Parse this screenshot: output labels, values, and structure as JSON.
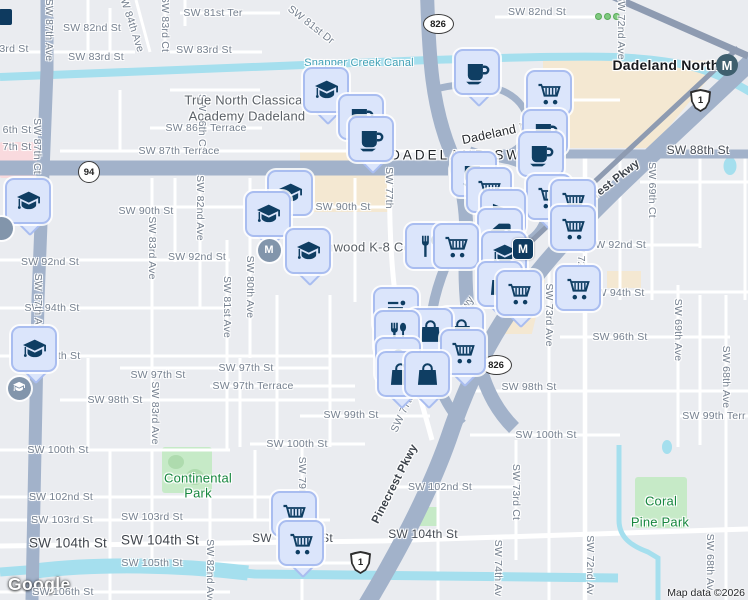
{
  "attribution": {
    "logo": "Google",
    "map_data": "Map data ©2026"
  },
  "colors": {
    "land": "#eaecf0",
    "road_major": "#a2b2ca",
    "road_minor": "#ffffff",
    "water": "#a5dfee",
    "park": "#c6eac7",
    "commercial": "#f4e8d2",
    "pin_fill": "#dbe5fb",
    "pin_border": "#a9bdf0",
    "pin_icon": "#0f3e63",
    "park_text": "#17873f",
    "water_text": "#41a0b5"
  },
  "labels": [
    {
      "t": "SW 82nd St",
      "x": 92,
      "y": 28
    },
    {
      "t": "3rd St",
      "x": 14,
      "y": 49
    },
    {
      "t": "SW 83rd St",
      "x": 96,
      "y": 57
    },
    {
      "t": "SW 84th Ave",
      "x": 131,
      "y": 22,
      "r": 72
    },
    {
      "t": "SW 83rd Ct",
      "x": 165,
      "y": 24,
      "r": 90
    },
    {
      "t": "SW 81st Ter",
      "x": 213,
      "y": 13
    },
    {
      "t": "SW 81st Dr",
      "x": 311,
      "y": 25,
      "r": 38
    },
    {
      "t": "SW 83rd St",
      "x": 204,
      "y": 50
    },
    {
      "t": "SW 82nd St",
      "x": 537,
      "y": 12
    },
    {
      "t": "SW 72nd Ave",
      "x": 621,
      "y": 27,
      "r": 90
    },
    {
      "t": "SW 86th Terrace",
      "x": 206,
      "y": 128
    },
    {
      "t": "6th St",
      "x": 17,
      "y": 130
    },
    {
      "t": "7th St",
      "x": 17,
      "y": 147
    },
    {
      "t": "SW 87th Ct",
      "x": 37,
      "y": 146,
      "r": 90
    },
    {
      "t": "SW 86th Ct",
      "x": 202,
      "y": 122,
      "r": 90
    },
    {
      "t": "SW 87th Terrace",
      "x": 179,
      "y": 151
    },
    {
      "t": "SW 90th St",
      "x": 146,
      "y": 211
    },
    {
      "t": "SW 90th St",
      "x": 343,
      "y": 207
    },
    {
      "t": "SW 82nd Ave",
      "x": 200,
      "y": 208,
      "r": 90
    },
    {
      "t": "SW 83rd Ave",
      "x": 152,
      "y": 248,
      "r": 90
    },
    {
      "t": "SW 92nd St",
      "x": 50,
      "y": 262
    },
    {
      "t": "SW 92nd St",
      "x": 197,
      "y": 257
    },
    {
      "t": "SW 80th Ave",
      "x": 250,
      "y": 287,
      "r": 90
    },
    {
      "t": "SW 81st Ave",
      "x": 227,
      "y": 307,
      "r": 90
    },
    {
      "t": "SW 92nd St",
      "x": 617,
      "y": 245
    },
    {
      "t": "SW 69th Ct",
      "x": 652,
      "y": 190,
      "r": 90
    },
    {
      "t": "SW 94th St",
      "x": 52,
      "y": 308
    },
    {
      "t": "SW 94th St",
      "x": 617,
      "y": 293
    },
    {
      "t": "SW 73rd Ave",
      "x": 549,
      "y": 315,
      "r": 90
    },
    {
      "t": "SW 72nd Ave",
      "x": 581,
      "y": 268,
      "r": 90
    },
    {
      "t": "SW 96th St",
      "x": 620,
      "y": 337
    },
    {
      "t": "SW 69th Ave",
      "x": 678,
      "y": 330,
      "r": 90
    },
    {
      "t": "SW 68th Ave",
      "x": 726,
      "y": 377,
      "r": 90
    },
    {
      "t": "6th St",
      "x": 66,
      "y": 356
    },
    {
      "t": "SW 97th St",
      "x": 158,
      "y": 375
    },
    {
      "t": "SW 97th St",
      "x": 246,
      "y": 368
    },
    {
      "t": "SW 97th Terrace",
      "x": 253,
      "y": 386
    },
    {
      "t": "SW 98th St",
      "x": 115,
      "y": 400
    },
    {
      "t": "SW 83rd Ave",
      "x": 155,
      "y": 413,
      "r": 90
    },
    {
      "t": "SW 99th St",
      "x": 351,
      "y": 415
    },
    {
      "t": "SW 98th St",
      "x": 529,
      "y": 387
    },
    {
      "t": "SW 99th Terr",
      "x": 714,
      "y": 416
    },
    {
      "t": "SW 100th St",
      "x": 546,
      "y": 435
    },
    {
      "t": "SW 100th St",
      "x": 58,
      "y": 450
    },
    {
      "t": "SW 100th St",
      "x": 297,
      "y": 444
    },
    {
      "t": "SW 102nd St",
      "x": 61,
      "y": 497
    },
    {
      "t": "SW 102nd St",
      "x": 440,
      "y": 487
    },
    {
      "t": "SW 103rd St",
      "x": 62,
      "y": 520
    },
    {
      "t": "SW 103rd St",
      "x": 152,
      "y": 517
    },
    {
      "t": "SW 105th St",
      "x": 152,
      "y": 563
    },
    {
      "t": "SW 106th St",
      "x": 63,
      "y": 592
    },
    {
      "t": "SW 82nd Ave",
      "x": 210,
      "y": 572,
      "r": 90
    },
    {
      "t": "SW 74th Av",
      "x": 498,
      "y": 568,
      "r": 90
    },
    {
      "t": "SW 73rd Ct",
      "x": 516,
      "y": 492,
      "r": 90
    },
    {
      "t": "SW 72nd Av",
      "x": 590,
      "y": 565,
      "r": 90
    },
    {
      "t": "SW 68th Av",
      "x": 710,
      "y": 562,
      "r": 90
    },
    {
      "t": "SW 79th Av",
      "x": 302,
      "y": 485,
      "r": 90
    },
    {
      "t": "SW 87th Ave",
      "x": 49,
      "y": 30,
      "r": 90
    },
    {
      "t": "SW 87th Ave",
      "x": 38,
      "y": 305,
      "r": 90
    },
    {
      "t": "SW 77th",
      "x": 389,
      "y": 188,
      "r": 90
    },
    {
      "t": "SW 77th Av",
      "x": 406,
      "y": 406,
      "r": -65
    },
    {
      "t": "e Hwy",
      "x": 463,
      "y": 310,
      "r": -55
    },
    {
      "t": "SW 88th St",
      "x": 698,
      "y": 150,
      "c": "M"
    },
    {
      "t": "SW 104th St",
      "x": 423,
      "y": 534,
      "c": "M"
    },
    {
      "t": "SW",
      "x": 262,
      "y": 538,
      "c": "M"
    },
    {
      "t": "St",
      "x": 327,
      "y": 538,
      "c": "M"
    },
    {
      "t": "SW 104th St",
      "x": 68,
      "y": 543,
      "c": "B"
    },
    {
      "t": "SW 104th St",
      "x": 160,
      "y": 540,
      "c": "B"
    },
    {
      "t": "DADELAND SW 88",
      "x": 470,
      "y": 155,
      "c": "A"
    },
    {
      "t": "Dadeland North",
      "x": 666,
      "y": 65,
      "c": "T"
    },
    {
      "t": "True North Classical",
      "x": 245,
      "y": 100,
      "c": "P"
    },
    {
      "t": "Academy Dadeland",
      "x": 247,
      "y": 116,
      "c": "P"
    },
    {
      "t": "Kenwood K-8 Center",
      "x": 372,
      "y": 247,
      "c": "P"
    },
    {
      "t": "Dadeland M",
      "x": 496,
      "y": 133,
      "r": -12,
      "c": "L"
    },
    {
      "t": "Snapper Creek Canal",
      "x": 359,
      "y": 63,
      "c": "W"
    },
    {
      "t": "Continental",
      "x": 198,
      "y": 478,
      "c": "K"
    },
    {
      "t": "Park",
      "x": 198,
      "y": 493,
      "c": "K"
    },
    {
      "t": "Coral",
      "x": 661,
      "y": 501,
      "c": "K"
    },
    {
      "t": "Pine Park",
      "x": 660,
      "y": 522,
      "c": "K"
    },
    {
      "t": "Pinecrest Pkwy",
      "x": 604,
      "y": 189,
      "r": -38,
      "c": "R"
    },
    {
      "t": "Pinecrest Pkwy",
      "x": 395,
      "y": 484,
      "r": -63,
      "c": "R"
    }
  ],
  "shields": [
    {
      "k": "oval",
      "t": "826",
      "x": 437,
      "y": 23
    },
    {
      "k": "oval",
      "t": "826",
      "x": 430,
      "y": 317
    },
    {
      "k": "oval",
      "t": "826",
      "x": 495,
      "y": 364
    },
    {
      "k": "circle",
      "t": "94",
      "x": 88,
      "y": 171
    },
    {
      "k": "us",
      "t": "1",
      "x": 700,
      "y": 100
    },
    {
      "k": "us",
      "t": "1",
      "x": 360,
      "y": 562
    }
  ],
  "markers": [
    {
      "icon": "coffee",
      "x": 477,
      "y": 72,
      "tail": true
    },
    {
      "icon": "graduation",
      "x": 326,
      "y": 90,
      "tail": true
    },
    {
      "icon": "cart",
      "x": 549,
      "y": 93,
      "tail": true
    },
    {
      "icon": "coffee",
      "x": 361,
      "y": 117
    },
    {
      "icon": "coffee",
      "x": 545,
      "y": 132
    },
    {
      "icon": "coffee",
      "x": 371,
      "y": 139,
      "tail": true
    },
    {
      "icon": "coffee",
      "x": 541,
      "y": 154,
      "tail": true
    },
    {
      "icon": "coffee",
      "x": 474,
      "y": 174
    },
    {
      "icon": "cart",
      "x": 489,
      "y": 190
    },
    {
      "icon": "graduation",
      "x": 290,
      "y": 193
    },
    {
      "icon": "cart",
      "x": 549,
      "y": 197,
      "tail": true
    },
    {
      "icon": "graduation",
      "x": 28,
      "y": 201,
      "tail": true
    },
    {
      "icon": "cart",
      "x": 573,
      "y": 202
    },
    {
      "icon": "arrow",
      "x": 503,
      "y": 212
    },
    {
      "icon": "graduation",
      "x": 268,
      "y": 214,
      "tail": true
    },
    {
      "icon": "cart",
      "x": 573,
      "y": 228
    },
    {
      "icon": "tag",
      "x": 500,
      "y": 231
    },
    {
      "icon": "restaurant",
      "x": 428,
      "y": 246
    },
    {
      "icon": "cart",
      "x": 456,
      "y": 246
    },
    {
      "icon": "graduation",
      "x": 308,
      "y": 251,
      "tail": true
    },
    {
      "icon": "graduation",
      "x": 504,
      "y": 254
    },
    {
      "icon": "bag",
      "x": 500,
      "y": 284,
      "tail": true
    },
    {
      "icon": "cart",
      "x": 578,
      "y": 288
    },
    {
      "icon": "cart",
      "x": 519,
      "y": 293,
      "tail": true
    },
    {
      "icon": "menu",
      "x": 396,
      "y": 310
    },
    {
      "icon": "bag",
      "x": 461,
      "y": 330
    },
    {
      "icon": "bag",
      "x": 430,
      "y": 331
    },
    {
      "icon": "restaurant",
      "x": 397,
      "y": 333
    },
    {
      "icon": "graduation",
      "x": 34,
      "y": 349,
      "tail": true
    },
    {
      "icon": "cart",
      "x": 463,
      "y": 352,
      "tail": true
    },
    {
      "icon": "bag",
      "x": 398,
      "y": 360
    },
    {
      "icon": "bag",
      "x": 400,
      "y": 374,
      "tail": true
    },
    {
      "icon": "bag",
      "x": 427,
      "y": 374,
      "tail": true
    },
    {
      "icon": "cart",
      "x": 294,
      "y": 514
    },
    {
      "icon": "cart",
      "x": 301,
      "y": 543,
      "tail": true
    }
  ],
  "badges": [
    {
      "k": "poi-circle",
      "g": "",
      "x": 1,
      "y": 228
    },
    {
      "k": "poi-circle",
      "g": "M",
      "x": 269,
      "y": 250
    },
    {
      "k": "poi-circle",
      "g": "cap",
      "x": 19,
      "y": 388
    },
    {
      "k": "metro-circle",
      "g": "M",
      "x": 727,
      "y": 65
    },
    {
      "k": "metro-square",
      "g": "M",
      "x": 522,
      "y": 248
    },
    {
      "k": "cut",
      "g": "",
      "x": 5,
      "y": 15
    }
  ],
  "areas": {
    "commercial": [
      {
        "x": 543,
        "y": 55,
        "w": 205,
        "h": 93,
        "clip": "polygon(0 6%, 88% 6%, 53% 100%, 0 100%)"
      },
      {
        "x": 300,
        "y": 150,
        "w": 92,
        "h": 62
      },
      {
        "x": 498,
        "y": 280,
        "w": 47,
        "h": 54,
        "clip": "polygon(28% 0, 100% 0, 72% 100%, 0 100%)"
      },
      {
        "x": 607,
        "y": 271,
        "w": 34,
        "h": 17
      }
    ],
    "pink": [
      {
        "x": 0,
        "y": 142,
        "w": 38,
        "h": 36
      }
    ],
    "parks": [
      {
        "x": 162,
        "y": 447,
        "w": 50,
        "h": 46,
        "blobs": true
      },
      {
        "x": 635,
        "y": 477,
        "w": 52,
        "h": 51
      },
      {
        "x": 409,
        "y": 507,
        "w": 30,
        "h": 19
      }
    ],
    "ponds": [
      {
        "x": 724,
        "y": 157,
        "w": 13,
        "h": 18
      },
      {
        "x": 662,
        "y": 440,
        "w": 10,
        "h": 14
      }
    ],
    "playground": {
      "x": 595,
      "y": 13
    }
  }
}
